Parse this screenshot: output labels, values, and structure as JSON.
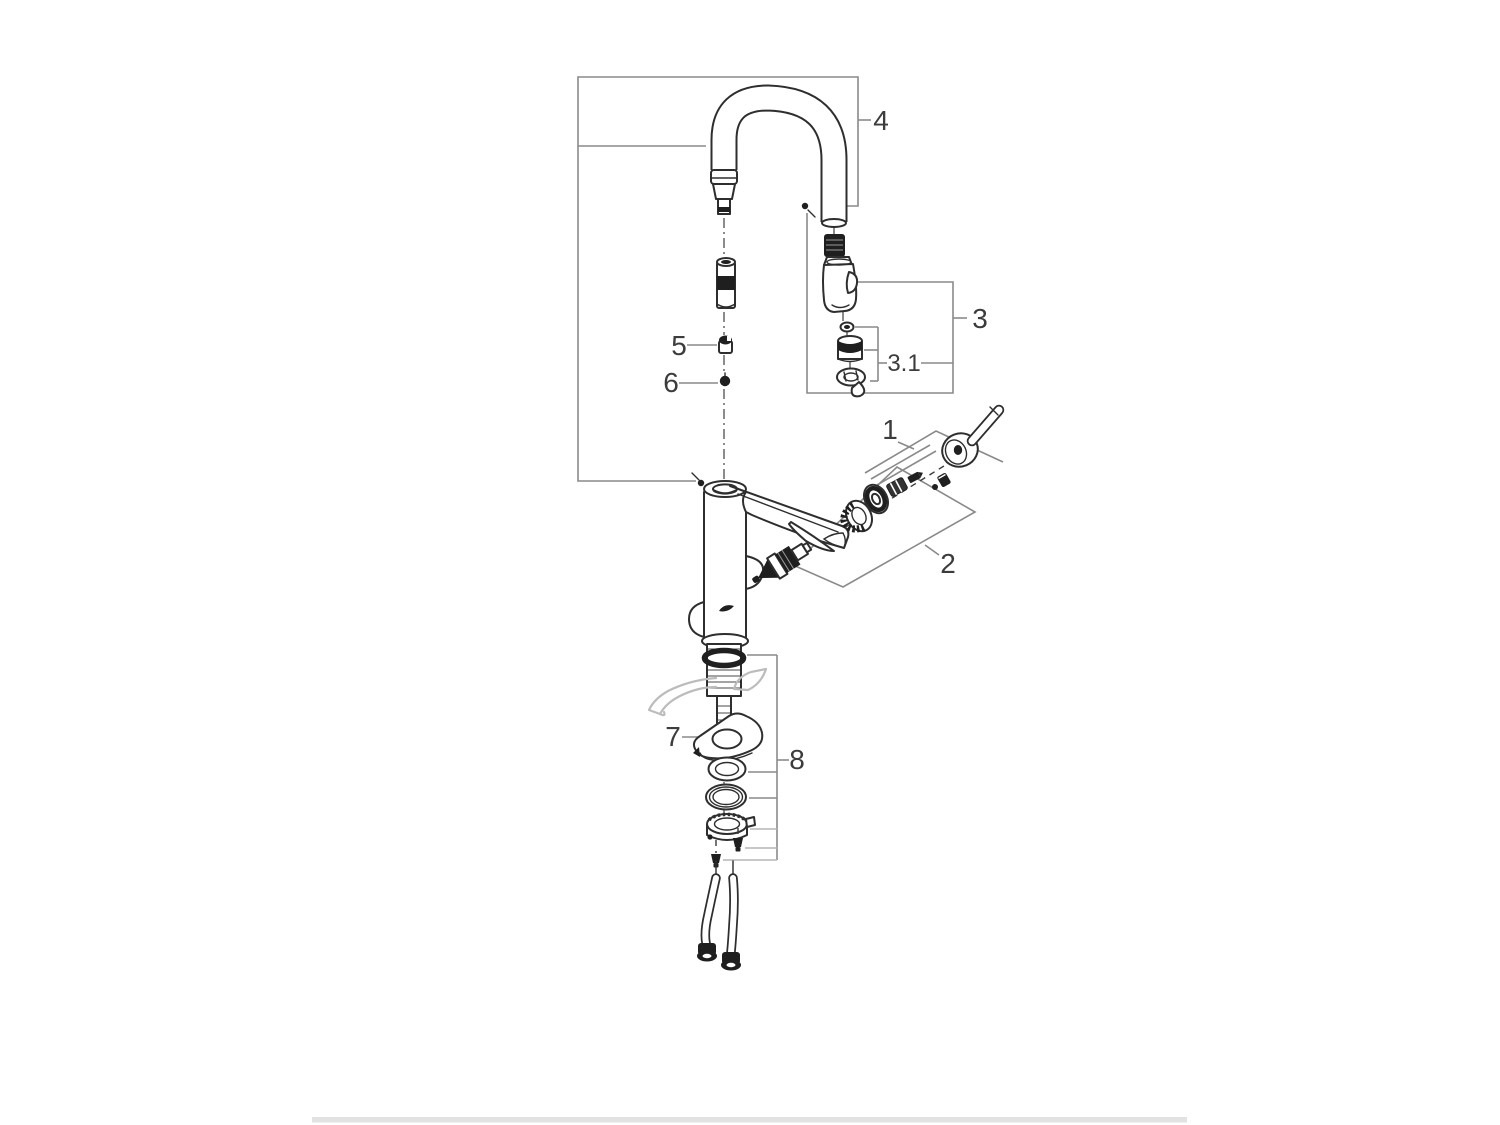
{
  "page": {
    "background": "#ffffff",
    "footer_bar_color": "#e2e2e2"
  },
  "diagram": {
    "type": "exploded-parts-diagram",
    "subject": "single-lever kitchen faucet with pull-out spray and gooseneck spout",
    "callouts": [
      {
        "id": "1",
        "label": "1"
      },
      {
        "id": "2",
        "label": "2"
      },
      {
        "id": "3",
        "label": "3"
      },
      {
        "id": "3.1",
        "label": "3.1"
      },
      {
        "id": "4",
        "label": "4"
      },
      {
        "id": "5",
        "label": "5"
      },
      {
        "id": "6",
        "label": "6"
      },
      {
        "id": "7",
        "label": "7"
      },
      {
        "id": "8",
        "label": "8"
      }
    ],
    "colors": {
      "part_outline": "#2e2e2e",
      "dark_fill": "#1f1f1f",
      "leader_line": "#8a8a8a",
      "sink_outline": "#bcbcbc",
      "background": "#ffffff"
    }
  }
}
